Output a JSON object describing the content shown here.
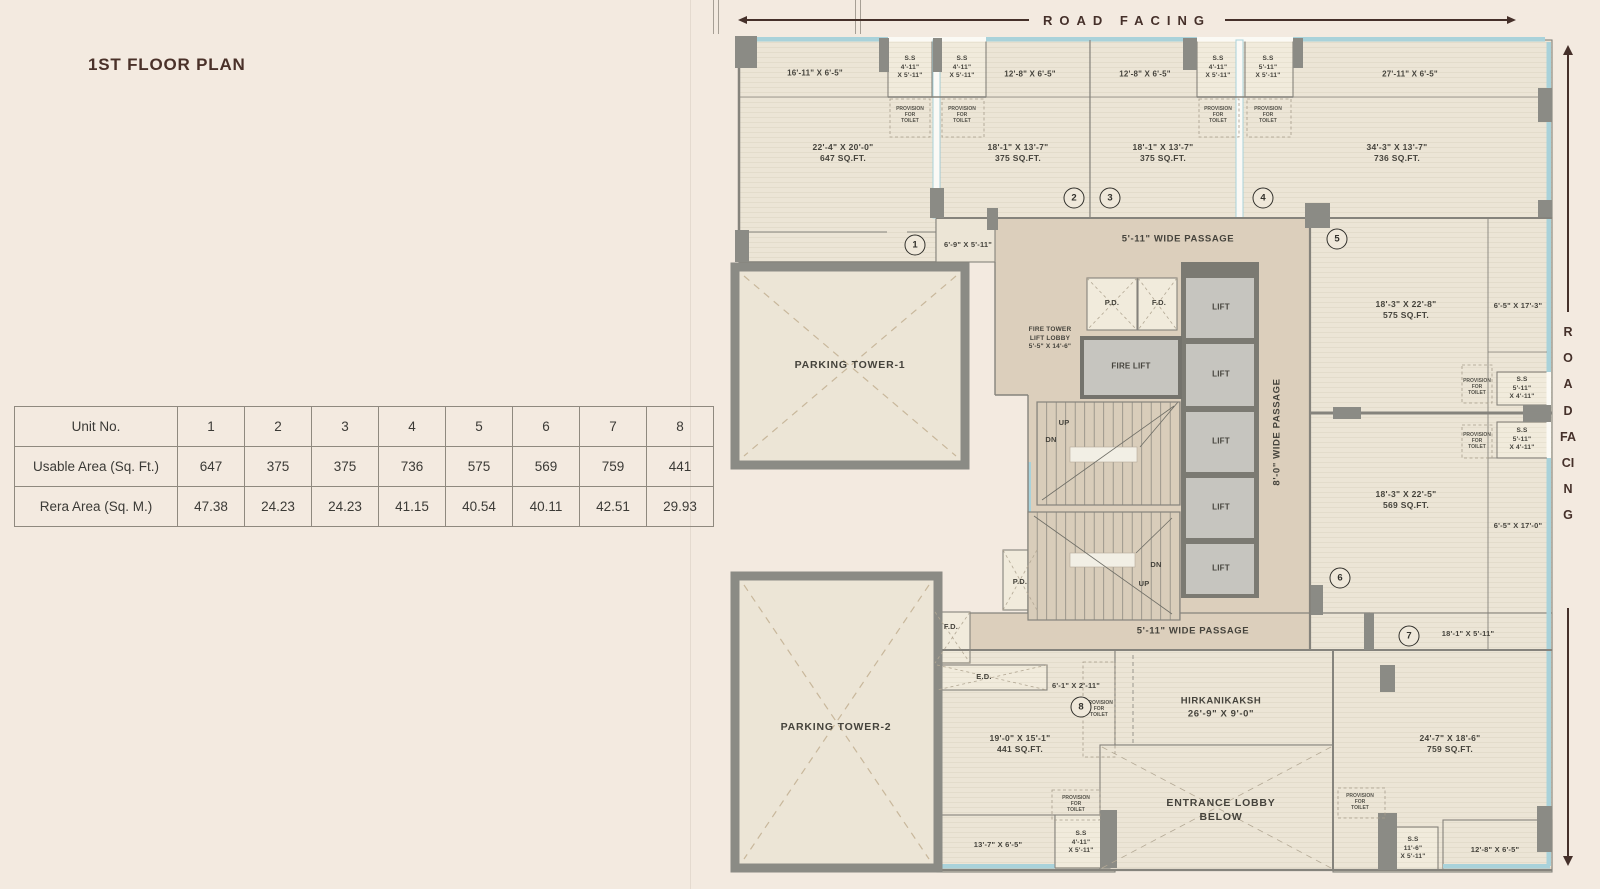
{
  "title": "1ST FLOOR PLAN",
  "table": {
    "rows": [
      {
        "label": "Unit No.",
        "values": [
          "1",
          "2",
          "3",
          "4",
          "5",
          "6",
          "7",
          "8"
        ]
      },
      {
        "label": "Usable Area (Sq. Ft.)",
        "values": [
          "647",
          "375",
          "375",
          "736",
          "575",
          "569",
          "759",
          "441"
        ]
      },
      {
        "label": "Rera Area (Sq. M.)",
        "values": [
          "47.38",
          "24.23",
          "24.23",
          "41.15",
          "40.54",
          "40.11",
          "42.51",
          "29.93"
        ]
      }
    ]
  },
  "plan": {
    "road_facing": "ROAD FACING",
    "units": {
      "u1": {
        "balcony": "16'-11\" X 6'-5\"",
        "room": "22'-4\" X 20'-0\"\n647 SQ.FT."
      },
      "u2": {
        "balcony": "12'-8\" X 6'-5\"",
        "room": "18'-1\" X 13'-7\"\n375 SQ.FT."
      },
      "u3": {
        "balcony": "12'-8\" X 6'-5\"",
        "room": "18'-1\" X 13'-7\"\n375 SQ.FT."
      },
      "u4": {
        "balcony": "27'-11\" X 6'-5\"",
        "room": "34'-3\" X 13'-7\"\n736 SQ.FT."
      },
      "u5": {
        "balcony": "6'-5\" X 17'-3\"",
        "room": "18'-3\" X 22'-8\"\n575 SQ.FT."
      },
      "u6": {
        "balcony": "6'-5\" X 17'-0\"",
        "room": "18'-3\" X 22'-5\"\n569 SQ.FT."
      },
      "u7": {
        "balcony": "12'-8\" X 6'-5\"",
        "room": "24'-7\" X 18'-6\"\n759 SQ.FT.",
        "entry": "18'-1\" X 5'-11\""
      },
      "u8": {
        "balcony": "13'-7\" X 6'-5\"",
        "room": "19'-0\" X 15'-1\"\n441 SQ.FT.",
        "entry": "6'-1\" X 2'-11\""
      }
    },
    "ss_4_11": "S.S\n4'-11\"\nX 5'-11\"",
    "ss_5_11": "S.S\n5'-11\"\nX 5'-11\"",
    "ss_right": "S.S\n5'-11\"\nX 4'-11\"",
    "ss_11_6": "S.S\n11'-6\"\nX 5'-11\"",
    "pft": "PROVISION\nFOR\nTOILET",
    "passage_u1": "6'-9\" X 5'-11\"",
    "passage_top": "5'-11\" WIDE PASSAGE",
    "passage_bottom": "5'-11\" WIDE PASSAGE",
    "passage_vertical": "8'-0\" WIDE PASSAGE",
    "parking1": "PARKING TOWER-1",
    "parking2": "PARKING TOWER-2",
    "fire_lobby": "FIRE TOWER\nLIFT LOBBY\n5'-5\" X 14'-6\"",
    "fire_lift": "FIRE LIFT",
    "lift": "LIFT",
    "pd": "P.D.",
    "fd": "F.D.",
    "ed": "E.D.",
    "up": "UP",
    "dn": "DN",
    "hirkanikaksh": "HIRKANIKAKSH\n26'-9\" X 9'-0\"",
    "entrance_lobby": "ENTRANCE LOBBY\nBELOW",
    "circles": [
      "1",
      "2",
      "3",
      "4",
      "5",
      "6",
      "7",
      "8"
    ]
  }
}
